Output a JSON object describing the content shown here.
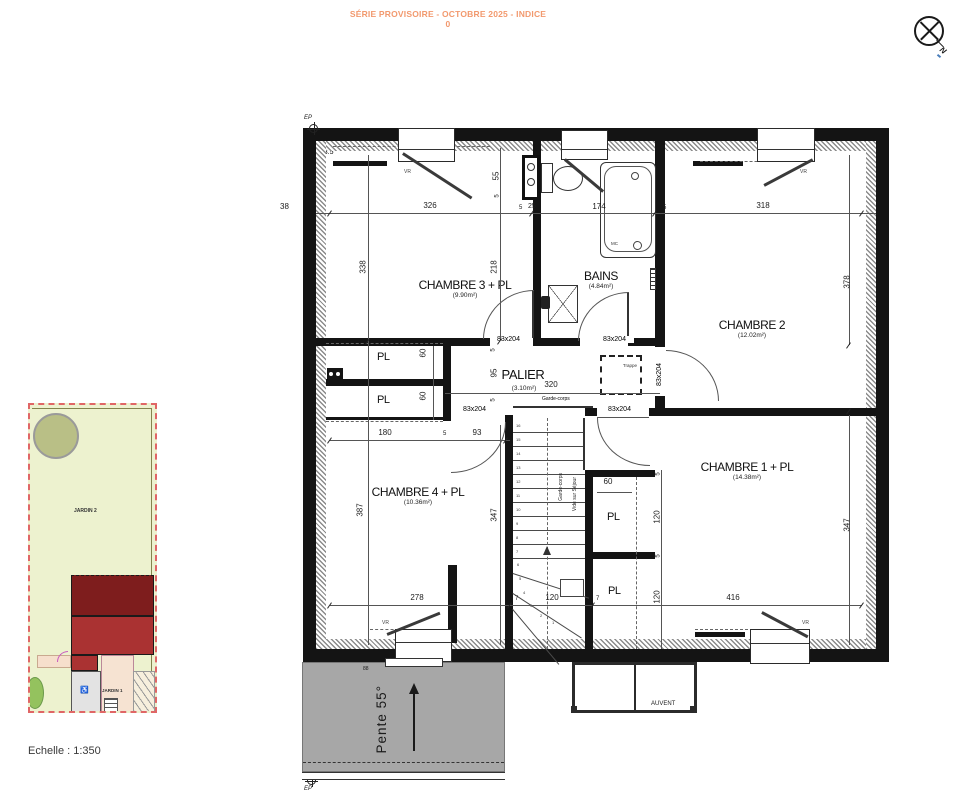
{
  "header": {
    "title": "SÉRIE PROVISOIRE - OCTOBRE 2025 - INDICE 0"
  },
  "compass": {
    "north": "N"
  },
  "site_plan": {
    "jardin2": "JARDIN 2",
    "jardin1": "JARDIN 1",
    "scale": "Echelle : 1:350"
  },
  "rooms": {
    "chambre3": {
      "name": "CHAMBRE 3 + PL",
      "area": "(9.90m²)"
    },
    "bains": {
      "name": "BAINS",
      "area": "(4.84m²)"
    },
    "chambre2": {
      "name": "CHAMBRE 2",
      "area": "(12.02m²)"
    },
    "palier": {
      "name": "PALIER",
      "area": "(3.10m²)"
    },
    "chambre4": {
      "name": "CHAMBRE 4 + PL",
      "area": "(10.36m²)"
    },
    "chambre1": {
      "name": "CHAMBRE 1 + PL",
      "area": "(14.38m²)"
    }
  },
  "labels": {
    "pl": "PL",
    "vr": "VR",
    "ep": "EP",
    "trappe": "Trappe",
    "garde_corps": "Garde-corps",
    "vide_sur_sejour": "Vide sur Séjour",
    "door_size": "83x204",
    "mc": "MC",
    "pente": "Pente 55°",
    "auvent": "AUVENT"
  },
  "dims": {
    "d5": "5",
    "d7": "7",
    "d25": "25",
    "d38": "38",
    "d55": "55",
    "d60": "60",
    "d88": "88",
    "d93": "93",
    "d95": "95",
    "d120": "120",
    "d173_5": "173.5",
    "d174": "174",
    "d180": "180",
    "d218": "218",
    "d278": "278",
    "d318": "318",
    "d320": "320",
    "d326": "326",
    "d338": "338",
    "d347": "347",
    "d378": "378",
    "d387": "387",
    "d416": "416"
  },
  "stairs": {
    "treads": [
      "16",
      "15",
      "14",
      "13",
      "12",
      "11",
      "10",
      "9",
      "8",
      "7",
      "6",
      "5",
      "4",
      "3",
      "2",
      "1"
    ]
  },
  "colors": {
    "accent": "#f2996e",
    "wall": "#141414",
    "roof_gray": "#a7a7a7",
    "site_border": "#e06666",
    "garden_fill": "#edf2cf",
    "roof_dark": "#7e1d1d",
    "roof_red": "#aa3232"
  }
}
